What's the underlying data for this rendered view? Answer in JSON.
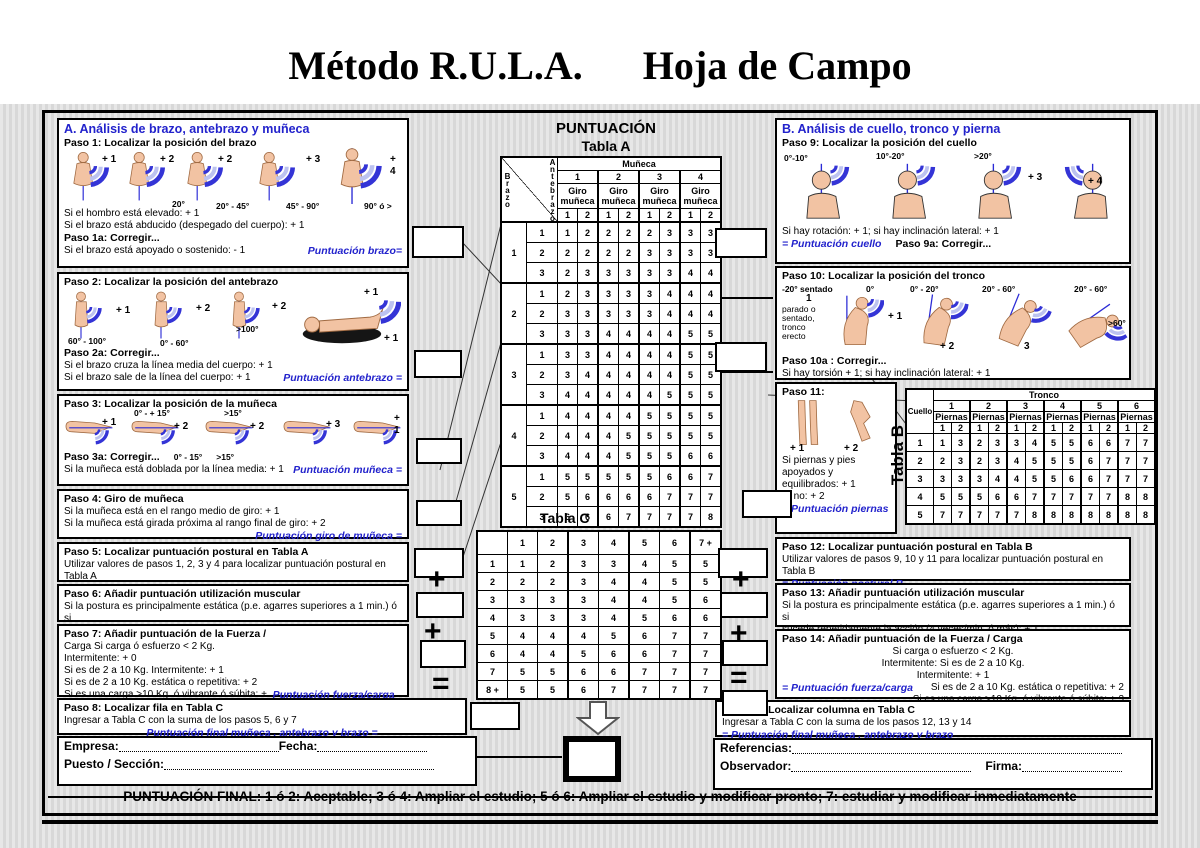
{
  "title": "Método R.U.L.A.      Hoja de Campo",
  "footer_line": "PUNTUACIÓN FINAL: 1 ó 2: Aceptable; 3 ó 4: Ampliar el estudio; 5 ó 6: Ampliar el estudio y modificar pronto; 7: estudiar y modificar inmediatamente",
  "ops": {
    "plus": "+",
    "equals": "="
  },
  "sectionA": {
    "header": "A. Análisis de brazo, antebrazo y muñeca",
    "paso1": {
      "title": "Paso 1: Localizar la posición del brazo",
      "scores": [
        "+ 1",
        "+ 2",
        "+ 2",
        "+ 3",
        "+ 4"
      ],
      "angles": [
        "20°",
        "20° - 45°",
        "45° - 90°",
        "90° ó >"
      ],
      "line1": "Si el hombro está elevado: + 1",
      "line2": "Si el brazo está abducido (despegado del cuerpo): + 1",
      "correg": "Paso 1a: Corregir...",
      "line3": "Si el brazo está apoyado o sostenido: - 1",
      "score_label": "Puntuación brazo="
    },
    "paso2": {
      "title": "Paso 2: Localizar la posición del antebrazo",
      "scores": [
        "+ 1",
        "+ 2",
        "+ 2",
        "+ 1",
        "+ 1"
      ],
      "angles": [
        "60° - 100°",
        "0° - 60°",
        ">100°"
      ],
      "correg": "Paso 2a: Corregir...",
      "line1": "Si el brazo cruza la línea media del cuerpo: + 1",
      "line2": "Si el brazo sale de la línea del cuerpo: + 1",
      "score_label": "Puntuación antebrazo ="
    },
    "paso3": {
      "title": "Paso 3: Localizar la posición de la muñeca",
      "scores": [
        "+ 1",
        "+ 2",
        "+ 2",
        "+ 3",
        "+ 1"
      ],
      "angles": [
        "0° - + 15°",
        ">15°",
        "0° - 15°",
        ">15°"
      ],
      "correg": "Paso 3a: Corregir...",
      "line1": "Si la muñeca está doblada por la línea media: + 1",
      "score_label": "Puntuación muñeca ="
    },
    "paso4": {
      "title": "Paso 4: Giro de muñeca",
      "line1": "Si la muñeca está en el rango medio de giro: + 1",
      "line2": "Si la muñeca está girada próxima al rango final de giro: + 2",
      "score_label": "Puntuación giro de muñeca ="
    },
    "paso5": {
      "title": "Paso 5: Localizar puntuación postural en Tabla A",
      "line1": "Utilizar valores de pasos 1, 2, 3 y 4 para localizar puntuación postural  en Tabla A",
      "score_label": "Puntuación postural A ="
    },
    "paso6": {
      "title": "Paso 6: Añadir puntuación utilización muscular",
      "line1": "Si la postura es principalmente estática (p.e. agarres superiores a 1 min.) ó si",
      "line2": "sucede repetidamente la acción (4 veces/min. ó más): + 1",
      "score_label": "Puntuación muscular ="
    },
    "paso7": {
      "title": "Paso 7: Añadir puntuación de la Fuerza /",
      "line1": "Carga Si carga ó esfuerzo < 2 Kg.",
      "line2": "Intermitente: + 0",
      "line3": "Si es de 2 a 10 Kg. Intermitente: + 1",
      "line4": "Si es de 2 a 10 Kg. estática o repetitiva: + 2",
      "line5": "Si es una carga >10 Kg. ó vibrante ó súbita: + 3",
      "score_label": "Puntuación fuerza/carga ="
    },
    "paso8": {
      "title": "Paso 8: Localizar fila en Tabla C",
      "line1": "Ingresar a Tabla C con la suma de los pasos 5, 6 y 7",
      "score_label": "Puntuación final muñeca , antebrazo y brazo  ="
    },
    "footer": {
      "empresa": "Empresa:",
      "fecha": "Fecha:",
      "puesto": "Puesto  /  Sección:"
    }
  },
  "center": {
    "puntuacion": "PUNTUACIÓN",
    "tabla_a": {
      "title": "Tabla A",
      "brazo": "Brazo",
      "antebrazo": "Antebrazo",
      "munieca": "Muñeca",
      "giro": "Giro muñeca",
      "groups": [
        "1",
        "2",
        "3",
        "4"
      ],
      "subs": [
        "1",
        "2"
      ],
      "rows": [
        {
          "b": "1",
          "subs": [
            [
              "1",
              [
                1,
                2,
                2,
                2,
                2,
                3,
                3,
                3
              ]
            ],
            [
              "2",
              [
                2,
                2,
                2,
                2,
                3,
                3,
                3,
                3
              ]
            ],
            [
              "3",
              [
                2,
                3,
                3,
                3,
                3,
                3,
                4,
                4
              ]
            ]
          ]
        },
        {
          "b": "2",
          "subs": [
            [
              "1",
              [
                2,
                3,
                3,
                3,
                3,
                4,
                4,
                4
              ]
            ],
            [
              "2",
              [
                3,
                3,
                3,
                3,
                3,
                4,
                4,
                4
              ]
            ],
            [
              "3",
              [
                3,
                3,
                4,
                4,
                4,
                4,
                5,
                5
              ]
            ]
          ]
        },
        {
          "b": "3",
          "subs": [
            [
              "1",
              [
                3,
                3,
                4,
                4,
                4,
                4,
                5,
                5
              ]
            ],
            [
              "2",
              [
                3,
                4,
                4,
                4,
                4,
                4,
                5,
                5
              ]
            ],
            [
              "3",
              [
                4,
                4,
                4,
                4,
                4,
                5,
                5,
                5
              ]
            ]
          ]
        },
        {
          "b": "4",
          "subs": [
            [
              "1",
              [
                4,
                4,
                4,
                4,
                5,
                5,
                5,
                5
              ]
            ],
            [
              "2",
              [
                4,
                4,
                4,
                5,
                5,
                5,
                5,
                5
              ]
            ],
            [
              "3",
              [
                4,
                4,
                4,
                5,
                5,
                5,
                6,
                6
              ]
            ]
          ]
        },
        {
          "b": "5",
          "subs": [
            [
              "1",
              [
                5,
                5,
                5,
                5,
                5,
                6,
                6,
                7
              ]
            ],
            [
              "2",
              [
                5,
                6,
                6,
                6,
                6,
                7,
                7,
                7
              ]
            ],
            [
              "3",
              [
                6,
                6,
                6,
                7,
                7,
                7,
                7,
                8
              ]
            ]
          ]
        }
      ]
    },
    "tabla_c": {
      "title": "Tabla C",
      "cols": [
        "1",
        "2",
        "3",
        "4",
        "5",
        "6",
        "7 +"
      ],
      "rows": [
        [
          "1",
          [
            1,
            2,
            3,
            3,
            4,
            5,
            5
          ]
        ],
        [
          "2",
          [
            2,
            2,
            3,
            4,
            4,
            5,
            5
          ]
        ],
        [
          "3",
          [
            3,
            3,
            3,
            4,
            4,
            5,
            6
          ]
        ],
        [
          "4",
          [
            3,
            3,
            3,
            4,
            5,
            6,
            6
          ]
        ],
        [
          "5",
          [
            4,
            4,
            4,
            5,
            6,
            7,
            7
          ]
        ],
        [
          "6",
          [
            4,
            4,
            5,
            6,
            6,
            7,
            7
          ]
        ],
        [
          "7",
          [
            5,
            5,
            6,
            6,
            7,
            7,
            7
          ]
        ],
        [
          "8 +",
          [
            5,
            5,
            6,
            7,
            7,
            7,
            7
          ]
        ]
      ]
    }
  },
  "sectionB": {
    "header": "B. Análisis de cuello, tronco y pierna",
    "paso9": {
      "title": "Paso 9: Localizar la posición del cuello",
      "angles": [
        "0°-10°",
        "10°-20°",
        ">20°"
      ],
      "scores": [
        "+ 3",
        "+ 4"
      ],
      "line1": "Si hay rotación: + 1; si hay inclinación lateral: + 1",
      "score_label": "= Puntuación cuello",
      "correg": "Paso 9a: Corregir..."
    },
    "paso10": {
      "title": "Paso 10: Localizar la posición del tronco",
      "sentado": "-20° sentado",
      "uno": "1",
      "parado": "parado o sentado, tronco erecto",
      "angles": [
        "0°",
        "0° - 20°",
        "20° - 60°",
        "20° - 60°",
        ">60°"
      ],
      "scores": [
        "+ 1",
        "+ 2",
        "3"
      ],
      "correg": "Paso 10a : Corregir...",
      "line1": "Si hay torsión + 1; si hay inclinación lateral: + 1"
    },
    "paso11": {
      "title": "Paso 11:",
      "scores": [
        "+ 1",
        "+ 2"
      ],
      "line1": "Si piernas y pies apoyados y equilibrados: + 1",
      "line2": "Si no: + 2",
      "score_label": "= Puntuación piernas"
    },
    "tabla_b": {
      "title": "Tabla B",
      "cuello": "Cuello",
      "tronco": "Tronco",
      "piernas": "Piernas",
      "groups": [
        "1",
        "2",
        "3",
        "4",
        "5",
        "6"
      ],
      "subs": [
        "1",
        "2"
      ],
      "rows": [
        [
          "1",
          [
            1,
            3,
            2,
            3,
            3,
            4,
            5,
            5,
            6,
            6,
            7,
            7
          ]
        ],
        [
          "2",
          [
            2,
            3,
            2,
            3,
            4,
            5,
            5,
            5,
            6,
            7,
            7,
            7
          ]
        ],
        [
          "3",
          [
            3,
            3,
            3,
            4,
            4,
            5,
            5,
            6,
            6,
            7,
            7,
            7
          ]
        ],
        [
          "4",
          [
            5,
            5,
            5,
            6,
            6,
            7,
            7,
            7,
            7,
            7,
            8,
            8
          ]
        ],
        [
          "5",
          [
            7,
            7,
            7,
            7,
            7,
            8,
            8,
            8,
            8,
            8,
            8,
            8
          ]
        ]
      ]
    },
    "paso12": {
      "title": "Paso 12: Localizar puntuación postural en Tabla B",
      "line1": "Utilizar valores de pasos 9, 10 y 11 para localizar puntuación postural  en Tabla B",
      "score_label": "= Puntuación postural B"
    },
    "paso13": {
      "title": "Paso 13: Añadir puntuación utilización muscular",
      "line1": "Si la postura es principalmente estática (p.e. agarres superiores a 1 min.) ó si",
      "line2": "sucede repetidamente la acción (4 veces/min. ó más): + 1",
      "score_label": "= Puntuación uso muscular"
    },
    "paso14": {
      "title": "Paso 14: Añadir puntuación de la Fuerza / Carga",
      "line1": "Si carga o esfuerzo < 2 Kg.",
      "line2": "Intermitente: Si es de 2 a 10 Kg.",
      "line3": "Intermitente: + 1",
      "line4": "Si es de 2 a 10 Kg. estática o repetitiva: + 2",
      "line5": "Si es una carga >10 Kg. ó vibrante ó súbita: + 3",
      "score_label": "= Puntuación fuerza/carga"
    },
    "paso15": {
      "title": "Paso 15: Localizar columna en Tabla C",
      "line1": "Ingresar a Tabla C con la suma de los pasos 12, 13 y 14",
      "score_label": "= Puntuación final muñeca , antebrazo y brazo"
    },
    "footer": {
      "referencias": "Referencias:",
      "observador": "Observador:",
      "firma": "Firma:"
    }
  }
}
